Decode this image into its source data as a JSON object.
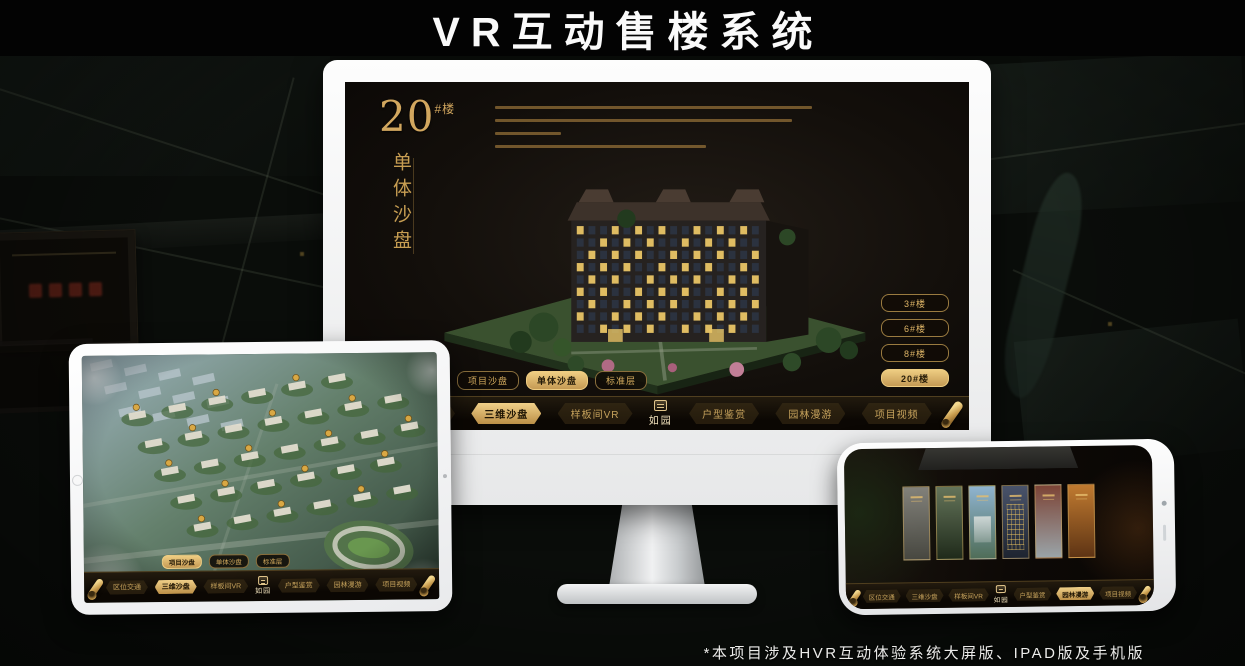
{
  "title": "VR互动售楼系统",
  "footnote": "*本项目涉及HVR互动体验系统大屏版、IPAD版及手机版",
  "brand": {
    "logo_text": "如园"
  },
  "colors": {
    "gold": "#cfa860",
    "gold_bright": "#efcd82",
    "gold_deep": "#9a7b40",
    "screen_bg": "#130f0b",
    "nav_bg": "#0b0703",
    "title_text": "#fafafa"
  },
  "monitor": {
    "headline_number": "20",
    "headline_suffix": "#楼",
    "headline_vertical": "单体沙盘",
    "floor_tabs": [
      {
        "label": "项目沙盘",
        "active": false
      },
      {
        "label": "单体沙盘",
        "active": true
      },
      {
        "label": "标准层",
        "active": false
      }
    ],
    "building_buttons": [
      {
        "label": "3#楼",
        "active": false
      },
      {
        "label": "6#楼",
        "active": false
      },
      {
        "label": "8#楼",
        "active": false
      },
      {
        "label": "20#楼",
        "active": true
      }
    ],
    "nav_items": [
      {
        "label": "区位交通",
        "active": false
      },
      {
        "label": "三维沙盘",
        "active": true
      },
      {
        "label": "样板间VR",
        "active": false
      },
      {
        "label": "户型鉴赏",
        "active": false
      },
      {
        "label": "园林漫游",
        "active": false
      },
      {
        "label": "项目视频",
        "active": false
      }
    ]
  },
  "tablet": {
    "floor_tabs": [
      {
        "label": "项目沙盘",
        "active": true
      },
      {
        "label": "单体沙盘",
        "active": false
      },
      {
        "label": "标准层",
        "active": false
      }
    ],
    "nav_items": [
      {
        "label": "区位交通",
        "active": false
      },
      {
        "label": "三维沙盘",
        "active": true
      },
      {
        "label": "样板间VR",
        "active": false
      },
      {
        "label": "户型鉴赏",
        "active": false
      },
      {
        "label": "园林漫游",
        "active": false
      },
      {
        "label": "项目视频",
        "active": false
      }
    ]
  },
  "phone": {
    "nav_items": [
      {
        "label": "区位交通",
        "active": false
      },
      {
        "label": "三维沙盘",
        "active": false
      },
      {
        "label": "样板间VR",
        "active": false
      },
      {
        "label": "户型鉴赏",
        "active": false
      },
      {
        "label": "园林漫游",
        "active": true
      },
      {
        "label": "项目视频",
        "active": false
      }
    ],
    "gallery_panels": [
      {
        "name": "interior-gray",
        "top": "#82817a",
        "bottom": "#474740"
      },
      {
        "name": "courtyard-green",
        "top": "#64745a",
        "bottom": "#1f2a1a"
      },
      {
        "name": "sky-building",
        "top": "#8fb4d0",
        "bottom": "#4f6d58"
      },
      {
        "name": "dusk-facade",
        "top": "#49536a",
        "bottom": "#1e2430"
      },
      {
        "name": "autumn-red",
        "top": "#7c4436",
        "bottom": "#9aa4a8"
      },
      {
        "name": "warm-interior",
        "top": "#c07a30",
        "bottom": "#5e3414"
      }
    ]
  }
}
